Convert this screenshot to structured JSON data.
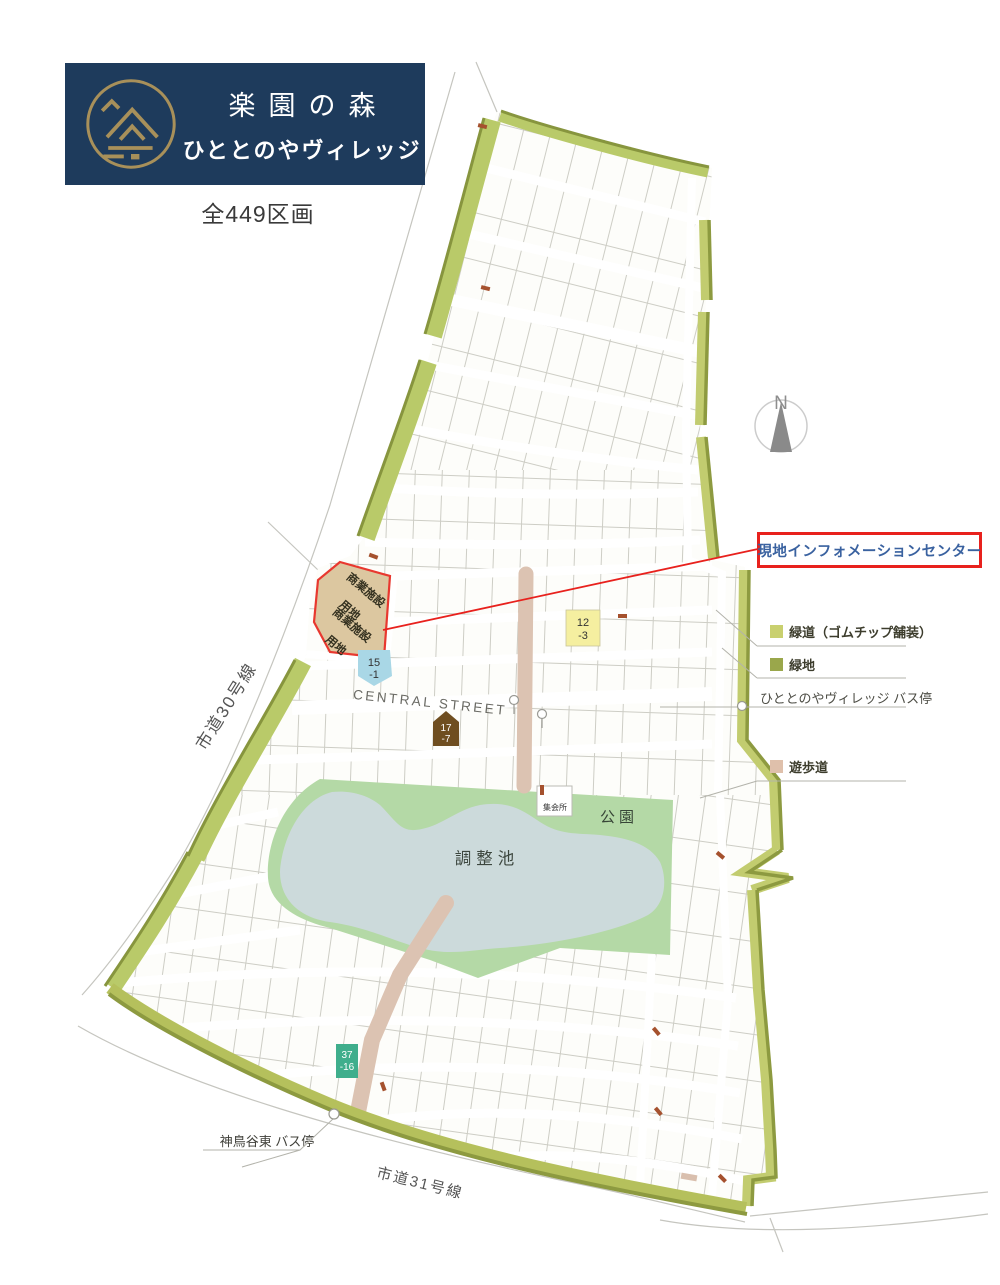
{
  "header": {
    "title": "楽園の森",
    "subtitle": "ひととのやヴィレッジ",
    "total_lots": "全449区画"
  },
  "compass": {
    "north_label": "N"
  },
  "callout": {
    "info_center": "現地インフォメーションセンター"
  },
  "legend": {
    "greenway": "緑道（ゴムチップ舗装）",
    "green_area": "緑地",
    "village_bus_stop": "ひととのやヴィレッジ バス停",
    "walking_path": "遊歩道"
  },
  "map": {
    "commercial_line1": "商業施設",
    "commercial_line2": "用地",
    "central_street": "CENTRAL STREET",
    "pond": "調整池",
    "park": "公園",
    "meeting_hall": "集会所",
    "road_30": "市道30号線",
    "road_31": "市道31号線",
    "east_bus_stop": "神鳥谷東 バス停",
    "lots": {
      "lot12": {
        "l1": "12",
        "l2": "-3"
      },
      "lot15": {
        "l1": "15",
        "l2": "-1"
      },
      "lot17": {
        "l1": "17",
        "l2": "-7"
      },
      "lot37": {
        "l1": "37",
        "l2": "-16"
      }
    }
  },
  "colors": {
    "banner_navy": "#1e3b5c",
    "logo_gold": "#a8905a",
    "callout_red": "#e8211d",
    "callout_blue": "#3a62a0",
    "greenway_light": "#c9d06f",
    "green_dark": "#9aa74b",
    "strip_light": "#b9ca69",
    "strip_edge": "#87953e",
    "path_pink": "#dcc3b2",
    "pond_blue": "#ccdadb",
    "park_green": "#b4d9a6",
    "commercial_tan": "#dcc7a0",
    "lot_yellow": "#f5efa0",
    "lot_blue": "#a9d7e6",
    "lot_teal": "#3fae8c",
    "lot_brown": "#6f4e20"
  }
}
